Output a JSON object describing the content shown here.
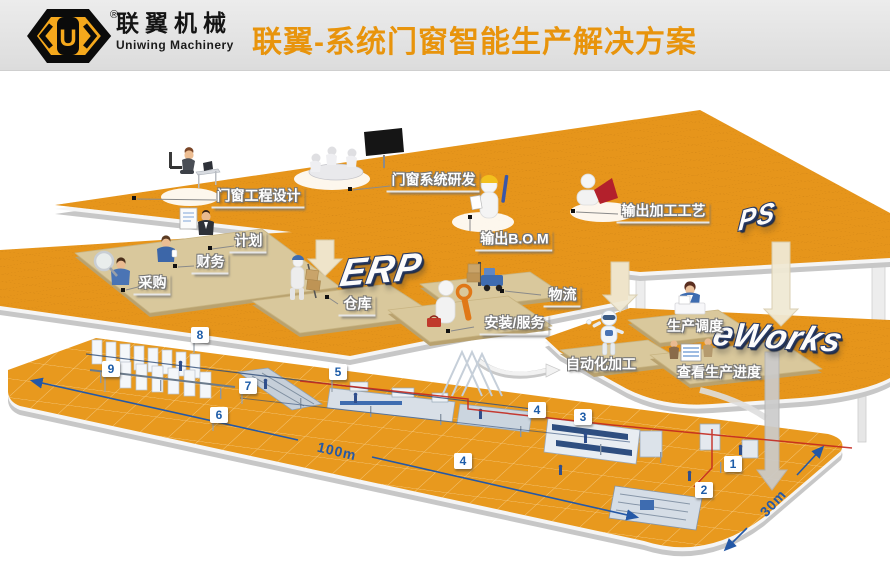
{
  "header": {
    "brand_cn": "联翼机械",
    "brand_en": "Uniwing Machinery",
    "registered": "®",
    "monogram": "U",
    "title": "联翼-系统门窗智能生产解决方案"
  },
  "platforms": {
    "ps": {
      "logo": "PS",
      "stations": {
        "design": "门窗工程设计",
        "rnd": "门窗系统研发",
        "bom": "输出B.O.M",
        "process": "输出加工工艺"
      }
    },
    "erp": {
      "logo": "ERP",
      "stations": {
        "plan": "计划",
        "finance": "财务",
        "procurement": "采购",
        "warehouse": "仓库",
        "logistics": "物流",
        "service": "安装/服务"
      }
    },
    "eworks": {
      "logo": "eWorks",
      "stations": {
        "scheduling": "生产调度",
        "automation": "自动化加工",
        "progress": "查看生产进度"
      }
    }
  },
  "factory": {
    "markers": [
      "1",
      "2",
      "3",
      "4",
      "4",
      "5",
      "6",
      "7",
      "8",
      "9"
    ],
    "dim_length": "100m",
    "dim_width": "30m"
  },
  "colors": {
    "accent_orange": "#E8940C",
    "platform_orange": "#E6951B",
    "marker_blue": "#1D5CA8",
    "dimension_blue": "#2458A6",
    "flow_red": "#C3281E"
  }
}
